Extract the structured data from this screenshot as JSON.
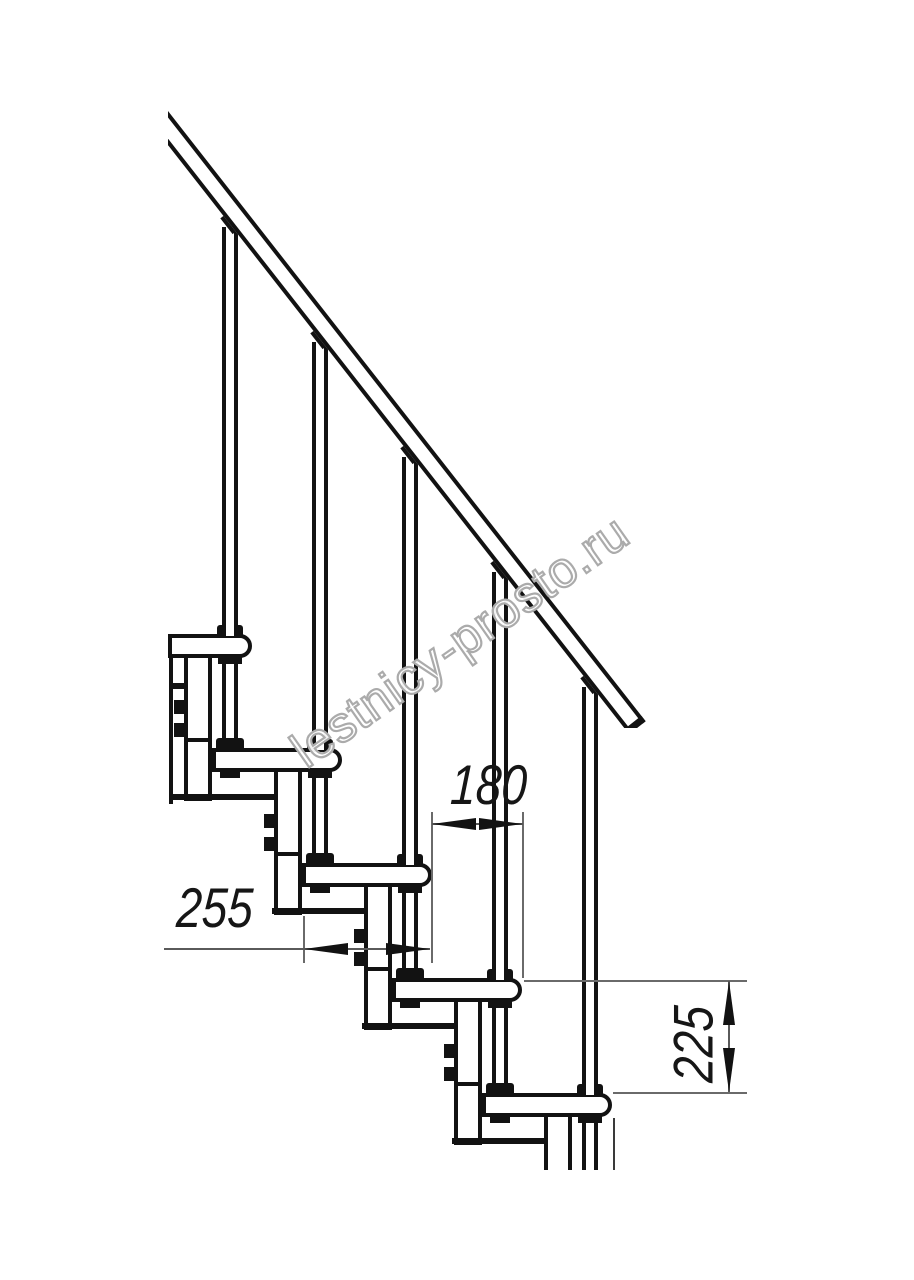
{
  "drawing": {
    "type": "staircase-side-view-technical-drawing",
    "dimensions": {
      "step_run": "180",
      "step_depth": "255",
      "step_rise": "225"
    },
    "watermark": "lestnicy-prosto.ru",
    "colors": {
      "line": "#121212",
      "dimension_line": "#5a5a5a",
      "watermark_outline": "#ababab",
      "background": "#ffffff"
    }
  }
}
